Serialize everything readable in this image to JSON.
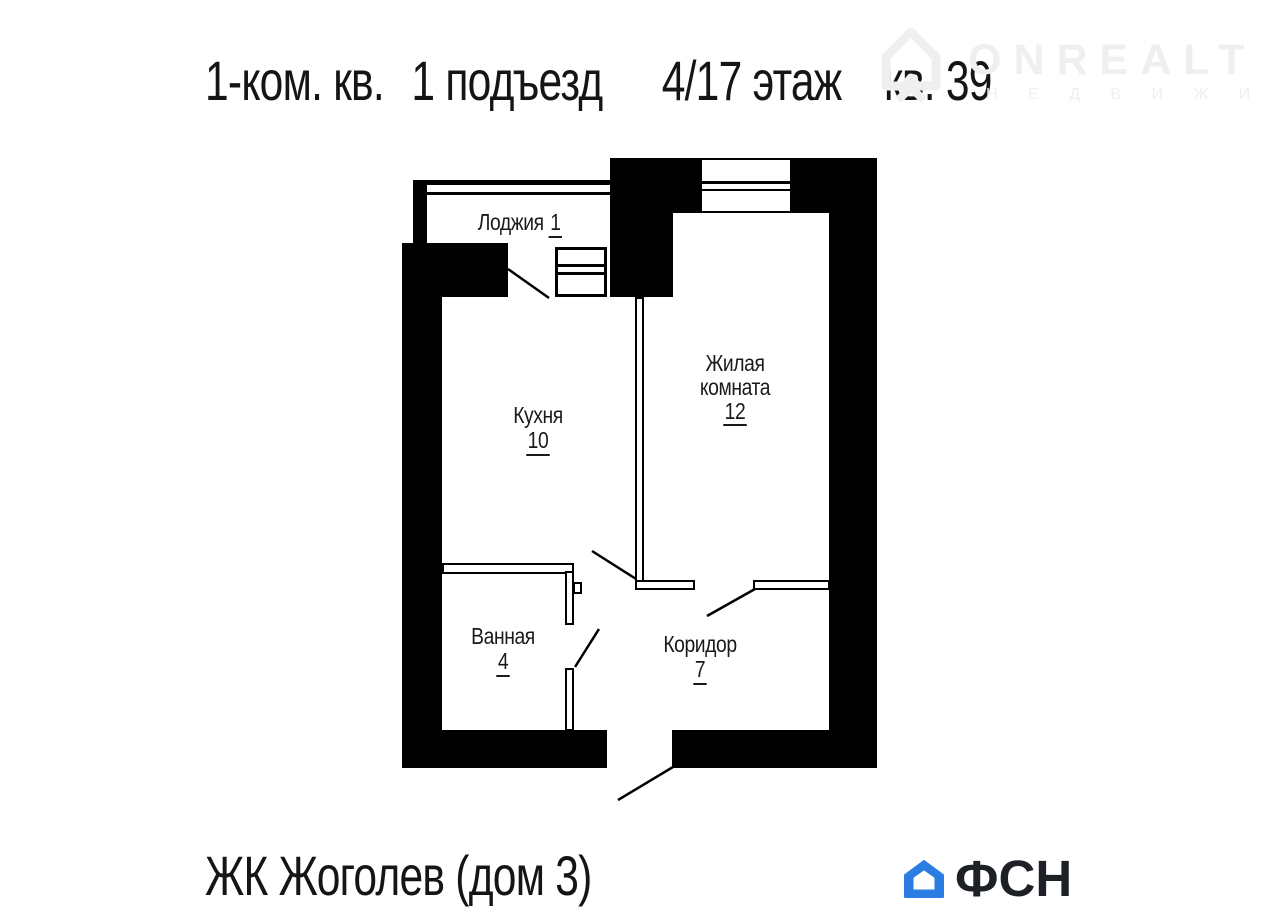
{
  "header": {
    "title_segments": [
      "1-ком. кв.",
      "1 подъезд",
      "4/17 этаж",
      "кв. 39"
    ]
  },
  "watermark": {
    "brand": "ONREALT",
    "subtitle": "Н Е Д В И Ж И М О С Т Ь",
    "color": "#f1eeee",
    "icon": "house-outline"
  },
  "plan": {
    "wall_color": "#000000",
    "rooms": [
      {
        "id": "loggia",
        "name": "Лоджия",
        "area": "1"
      },
      {
        "id": "kitchen",
        "name": "Кухня",
        "area": "10"
      },
      {
        "id": "living",
        "lines": [
          "Жилая",
          "комната"
        ],
        "area": "12"
      },
      {
        "id": "bathroom",
        "name": "Ванная",
        "area": "4"
      },
      {
        "id": "corridor",
        "name": "Коридор",
        "area": "7"
      }
    ]
  },
  "footer": {
    "project": "ЖК Жоголев (дом 3)",
    "brand": "ФСН",
    "brand_color": "#2b7de3",
    "brand_icon": "house"
  }
}
